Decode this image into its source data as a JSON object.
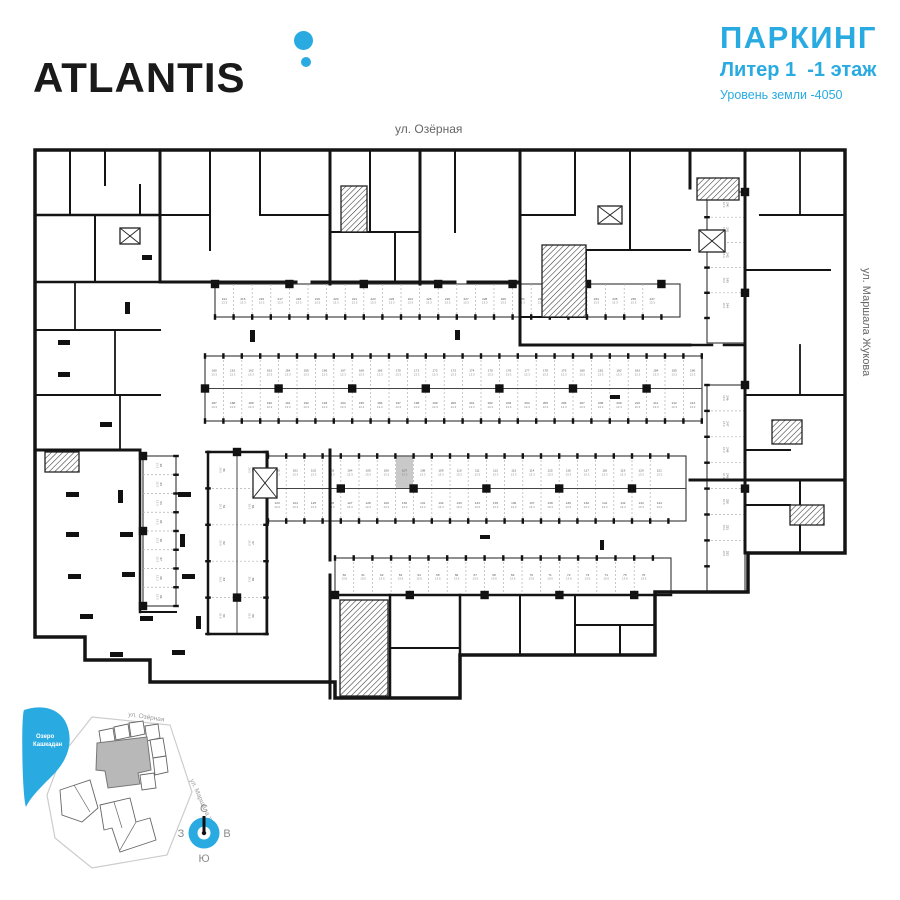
{
  "header": {
    "logo_text": "ATLANTIS",
    "title": "ПАРКИНГ",
    "subtitle": "Литер 1  -1 этаж",
    "level_note": "Уровень земли -4050",
    "accent_color": "#29ABE2"
  },
  "plan": {
    "street_top": "ул. Озёрная",
    "street_right": "ул. Маршала Жукова",
    "wall_color": "#141414",
    "highlight_color": "#c9c9c9",
    "outline": "35,150 845,150 845,553 748,553 748,592 655,592 655,655 460,655 460,698 335,698 335,682 150,682 150,660 85,660 85,637 35,637",
    "walls": [
      [
        160,
        150,
        160,
        282,
        3
      ],
      [
        330,
        150,
        330,
        284,
        3
      ],
      [
        420,
        150,
        420,
        284,
        3
      ],
      [
        520,
        150,
        520,
        345,
        3
      ],
      [
        690,
        150,
        690,
        188,
        3
      ],
      [
        745,
        150,
        745,
        553,
        3
      ],
      [
        160,
        282,
        296,
        282,
        3
      ],
      [
        312,
        282,
        420,
        282,
        3
      ],
      [
        420,
        282,
        455,
        282,
        3
      ],
      [
        468,
        282,
        520,
        282,
        3
      ],
      [
        520,
        345,
        690,
        345,
        3
      ],
      [
        690,
        345,
        712,
        345,
        2.5
      ],
      [
        724,
        345,
        745,
        345,
        2.5
      ],
      [
        35,
        215,
        160,
        215,
        2.5
      ],
      [
        35,
        282,
        160,
        282,
        2.5
      ],
      [
        35,
        330,
        160,
        330,
        2
      ],
      [
        35,
        395,
        160,
        395,
        2
      ],
      [
        70,
        150,
        70,
        215,
        2
      ],
      [
        105,
        150,
        105,
        185,
        2
      ],
      [
        140,
        185,
        140,
        215,
        2
      ],
      [
        95,
        215,
        95,
        282,
        2
      ],
      [
        75,
        282,
        75,
        330,
        1.8
      ],
      [
        115,
        330,
        115,
        395,
        1.8
      ],
      [
        120,
        395,
        120,
        450,
        1.8
      ],
      [
        35,
        450,
        140,
        450,
        3
      ],
      [
        140,
        450,
        140,
        612,
        2.5
      ],
      [
        140,
        612,
        176,
        612,
        2
      ],
      [
        208,
        452,
        267,
        452,
        2.5
      ],
      [
        208,
        452,
        208,
        634,
        2.5
      ],
      [
        267,
        452,
        267,
        634,
        2.5
      ],
      [
        208,
        634,
        267,
        634,
        2.5
      ],
      [
        330,
        450,
        330,
        560,
        3
      ],
      [
        330,
        575,
        330,
        698,
        3
      ],
      [
        210,
        150,
        210,
        250,
        2
      ],
      [
        160,
        215,
        210,
        215,
        2
      ],
      [
        260,
        150,
        260,
        215,
        2
      ],
      [
        260,
        215,
        330,
        215,
        2
      ],
      [
        370,
        150,
        370,
        232,
        2
      ],
      [
        330,
        232,
        420,
        232,
        2
      ],
      [
        395,
        232,
        395,
        282,
        2
      ],
      [
        455,
        150,
        455,
        232,
        2
      ],
      [
        575,
        150,
        575,
        215,
        2
      ],
      [
        630,
        150,
        630,
        250,
        2
      ],
      [
        520,
        215,
        575,
        215,
        2
      ],
      [
        575,
        250,
        690,
        250,
        2
      ],
      [
        586,
        250,
        586,
        317,
        2
      ],
      [
        520,
        317,
        586,
        317,
        2
      ],
      [
        760,
        215,
        845,
        215,
        2
      ],
      [
        745,
        270,
        830,
        270,
        2
      ],
      [
        800,
        150,
        800,
        215,
        1.8
      ],
      [
        800,
        345,
        800,
        395,
        1.8
      ],
      [
        745,
        395,
        845,
        395,
        2
      ],
      [
        745,
        450,
        790,
        450,
        2
      ],
      [
        690,
        480,
        845,
        480,
        3
      ],
      [
        800,
        480,
        800,
        553,
        2
      ],
      [
        745,
        505,
        790,
        505,
        2
      ],
      [
        335,
        595,
        671,
        595,
        2.5
      ],
      [
        460,
        595,
        460,
        655,
        2.5
      ],
      [
        390,
        595,
        390,
        698,
        2.5
      ],
      [
        390,
        648,
        460,
        648,
        2
      ],
      [
        520,
        595,
        520,
        655,
        2
      ],
      [
        575,
        595,
        575,
        655,
        2
      ],
      [
        575,
        625,
        655,
        625,
        2
      ],
      [
        620,
        625,
        620,
        655,
        2
      ]
    ],
    "stairs": [
      [
        341,
        186,
        26,
        46
      ],
      [
        542,
        245,
        44,
        72
      ],
      [
        45,
        452,
        34,
        20
      ],
      [
        340,
        600,
        48,
        96
      ],
      [
        697,
        178,
        42,
        22
      ],
      [
        772,
        420,
        30,
        24
      ],
      [
        790,
        505,
        34,
        20
      ]
    ],
    "xboxes": [
      [
        253,
        468,
        24,
        30
      ],
      [
        699,
        230,
        26,
        22
      ],
      [
        598,
        206,
        24,
        18
      ],
      [
        120,
        228,
        20,
        16
      ]
    ],
    "scatter_columns": [
      [
        66,
        492,
        13,
        5
      ],
      [
        118,
        490,
        5,
        13
      ],
      [
        178,
        492,
        13,
        5
      ],
      [
        66,
        532,
        13,
        5
      ],
      [
        120,
        532,
        13,
        5
      ],
      [
        180,
        534,
        5,
        13
      ],
      [
        68,
        574,
        13,
        5
      ],
      [
        122,
        572,
        13,
        5
      ],
      [
        182,
        574,
        13,
        5
      ],
      [
        80,
        614,
        13,
        5
      ],
      [
        140,
        616,
        13,
        5
      ],
      [
        196,
        616,
        5,
        13
      ],
      [
        110,
        652,
        13,
        5
      ],
      [
        172,
        650,
        13,
        5
      ],
      [
        58,
        340,
        12,
        5
      ],
      [
        58,
        372,
        12,
        5
      ],
      [
        125,
        302,
        5,
        12
      ],
      [
        100,
        422,
        12,
        5
      ],
      [
        142,
        255,
        10,
        5
      ],
      [
        250,
        330,
        5,
        12
      ],
      [
        455,
        330,
        5,
        10
      ],
      [
        610,
        395,
        10,
        4
      ],
      [
        480,
        535,
        10,
        4
      ],
      [
        600,
        540,
        4,
        10
      ]
    ],
    "stall_rows": [
      {
        "id": "row-a",
        "o": "h",
        "x": 215,
        "y": 284,
        "len": 465,
        "depth": 33,
        "rows": 1,
        "s": 18.6,
        "open": "bottom",
        "start": 214,
        "area": "13.3"
      },
      {
        "id": "row-b",
        "o": "h",
        "x": 205,
        "y": 356,
        "len": 497,
        "depth": 32.5,
        "rows": 2,
        "s": 18.4,
        "open": "both",
        "start": 160,
        "start2": 187,
        "area": "13.3"
      },
      {
        "id": "row-c",
        "o": "h",
        "x": 268,
        "y": 456,
        "len": 418,
        "depth": 32.5,
        "rows": 2,
        "s": 18.2,
        "open": "both",
        "start": 100,
        "start2": 123,
        "area": "13.3",
        "highlight": {
          "row": 0,
          "idx": 7
        }
      },
      {
        "id": "row-d",
        "o": "h",
        "x": 335,
        "y": 558,
        "len": 336,
        "depth": 37,
        "rows": 1,
        "s": 18.7,
        "open": "top",
        "start": 60,
        "area": "13.6"
      },
      {
        "id": "col-left",
        "o": "v",
        "x": 143,
        "y": 456,
        "len": 150,
        "depth": 33,
        "rows": 1,
        "s": 18.75,
        "open": "right",
        "start": 92,
        "area": "13.3"
      },
      {
        "id": "col-wide",
        "o": "v",
        "x": 208,
        "y": 452,
        "len": 182,
        "depth": 29,
        "rows": 2,
        "s": 36.4,
        "open": "both",
        "start": 80,
        "start2": 85,
        "area": "26.5"
      },
      {
        "id": "col-right-upper",
        "o": "v",
        "x": 707,
        "y": 192,
        "len": 151,
        "depth": 38,
        "rows": 1,
        "s": 25.2,
        "open": "left",
        "start": 240,
        "area": "18.0"
      },
      {
        "id": "col-right-lower",
        "o": "v",
        "x": 707,
        "y": 385,
        "len": 207,
        "depth": 38,
        "rows": 1,
        "s": 25.9,
        "open": "left",
        "start": 246,
        "area": "18.0"
      }
    ]
  },
  "site_map": {
    "lake_label_line1": "Озеро",
    "lake_label_line2": "Кашкадан",
    "lake_color": "#29ABE2",
    "street_top": "ул. Озёрная",
    "street_right": "ул. Маршала Жукова",
    "building_fill": "#b8b8b8"
  },
  "compass": {
    "north": "С",
    "south": "Ю",
    "west": "З",
    "east": "В",
    "ring_color": "#29ABE2"
  }
}
